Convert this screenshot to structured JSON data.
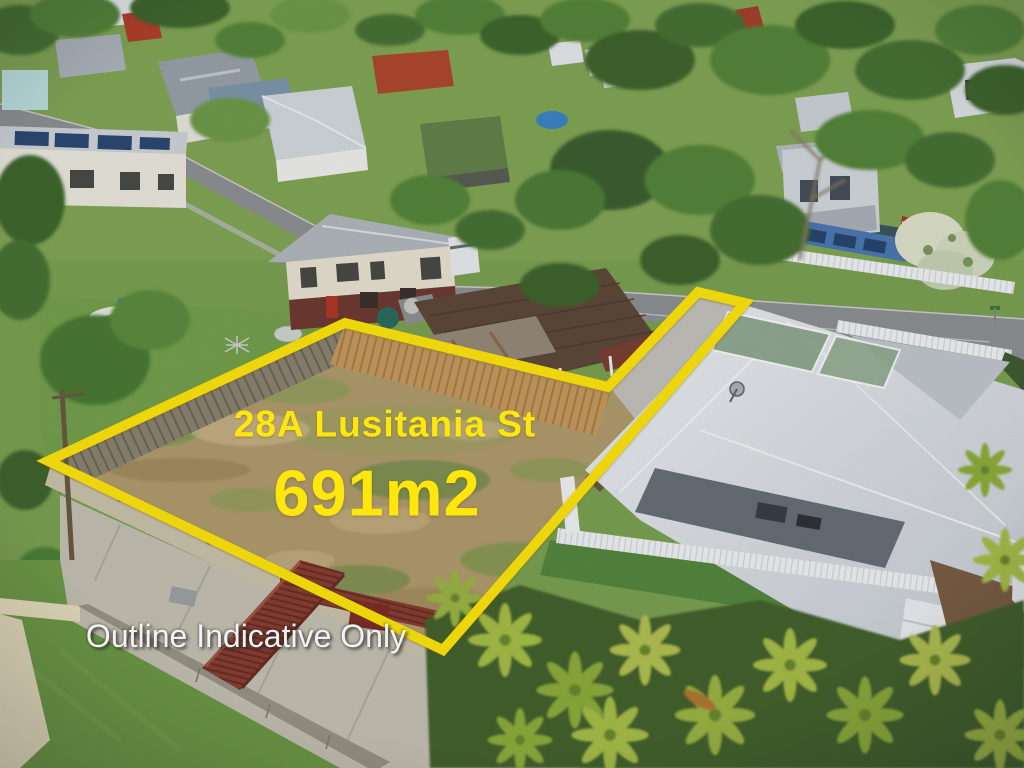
{
  "photo": {
    "type": "aerial-drone-photo",
    "subject": "vacant residential land for sale, suburban streetscape",
    "overlay": {
      "address": "28A Lusitania St",
      "area": "691m2",
      "disclaimer": "Outline Indicative Only"
    },
    "lot_outline": {
      "points": "48,461 345,323 608,387 698,292 745,303 443,650",
      "color": "#FFE70C",
      "stroke_width": 10
    },
    "palette": {
      "label_yellow": "#FFE70C",
      "disclaimer_white": "#F2F2F2",
      "grass_green": "#7CA253",
      "tree_green": "#4A7334",
      "lot_dirt": "#B29C6E",
      "road_grey": "#8F9295",
      "concrete": "#C6C2B4",
      "timber_fence_tan": "#C79C5F",
      "walkway_maroon": "#8A3F33",
      "neighbor_roof": "#DDE1E5",
      "palm_green": "#A8C04A"
    }
  }
}
